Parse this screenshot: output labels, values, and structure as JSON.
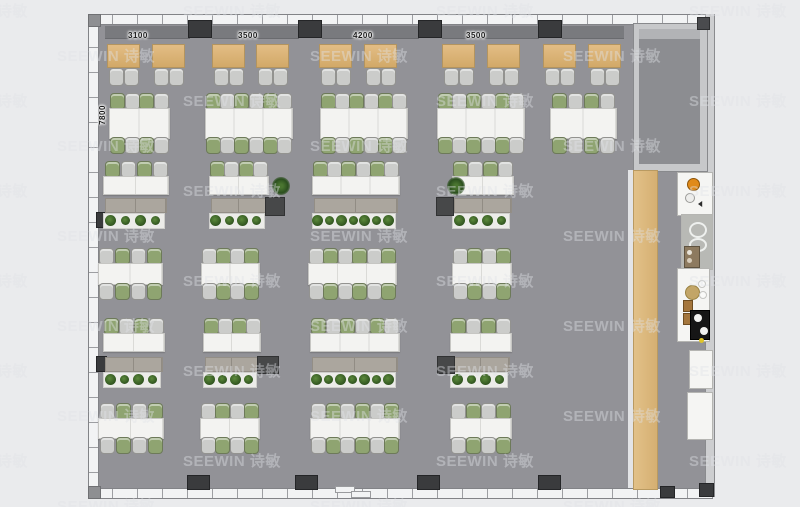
{
  "watermark": {
    "text": "SEEWIN 诗敏"
  },
  "labels": {
    "top_dimensions": [
      {
        "text": "3100",
        "cx": 142,
        "y": 31
      },
      {
        "text": "3500",
        "cx": 252,
        "y": 31
      },
      {
        "text": "4200",
        "cx": 367,
        "y": 31
      },
      {
        "text": "3500",
        "cx": 480,
        "y": 31
      }
    ],
    "left_dimension": {
      "text": "7800",
      "x": 90,
      "y": 103
    }
  },
  "colors": {
    "floor": "#929297",
    "outer_background": "#eaebed",
    "wall_window": "#f2f3f4",
    "column": "#3a3b3d",
    "booth_table_wood": "#d8b073",
    "bench_band": "#797a7e",
    "chair_green": "#8fa471",
    "chair_gray": "#cbccca",
    "desk_white": "#f3f3f1",
    "soft_bench": "#aba69e",
    "planter_box": "#ecece9",
    "plant_green": "#3f6b2f",
    "wood_strip": "#d9b67c",
    "accent_orange": "#e08a1a",
    "appliance_black": "#161616"
  },
  "plan": {
    "building": {
      "x": 88,
      "y": 14,
      "w": 625,
      "h": 483
    },
    "room": {
      "x": 633,
      "y": 23,
      "w": 73,
      "h": 147
    },
    "columns_top": [
      188,
      298,
      418,
      538
    ],
    "columns_bottom": [
      187,
      295,
      417,
      538
    ],
    "wall_blocks": [
      {
        "x": 96,
        "y": 212
      },
      {
        "x": 96,
        "y": 356
      }
    ],
    "bench_band_segments": [
      [
        105,
        85
      ],
      [
        212,
        87
      ],
      [
        322,
        97
      ],
      [
        442,
        97
      ],
      [
        562,
        62
      ]
    ],
    "booth_tables": [
      107,
      152,
      212,
      256,
      319,
      364,
      442,
      487,
      543,
      588
    ],
    "booth_table_y": 44,
    "booth_chair_y": 68,
    "workstation_rows": [
      {
        "y": 108,
        "h": 29,
        "first": "green",
        "clusters": [
          {
            "x": 109,
            "w": 59,
            "seats": 4
          },
          {
            "x": 205,
            "w": 86,
            "seats": 6
          },
          {
            "x": 320,
            "w": 86,
            "seats": 6
          },
          {
            "x": 437,
            "w": 86,
            "seats": 6
          },
          {
            "x": 550,
            "w": 65,
            "seats": 4
          }
        ]
      },
      {
        "y": 263,
        "h": 20,
        "first": "gray",
        "clusters": [
          {
            "x": 98,
            "w": 63,
            "seats": 4
          },
          {
            "x": 201,
            "w": 57,
            "seats": 4
          },
          {
            "x": 308,
            "w": 87,
            "seats": 6
          },
          {
            "x": 452,
            "w": 58,
            "seats": 4
          }
        ]
      },
      {
        "y": 418,
        "h": 19,
        "first": "gray",
        "clusters": [
          {
            "x": 98,
            "w": 64,
            "seats": 4
          },
          {
            "x": 200,
            "w": 58,
            "seats": 4
          },
          {
            "x": 310,
            "w": 88,
            "seats": 6
          },
          {
            "x": 450,
            "w": 60,
            "seats": 4
          }
        ]
      }
    ],
    "planter_rows": [
      {
        "desk_y": 176,
        "desk_h": 17,
        "bench_y": 198,
        "planter_y": 213,
        "first": "green",
        "clusters": [
          {
            "x": 103,
            "w": 64,
            "seats": 4,
            "plants": 4
          },
          {
            "x": 209,
            "w": 58,
            "seats": 4,
            "plants": 4
          },
          {
            "x": 312,
            "w": 86,
            "seats": 6,
            "plants": 7
          },
          {
            "x": 452,
            "w": 60,
            "seats": 4,
            "plants": 4
          }
        ],
        "side_boxes": [
          {
            "x": 265,
            "y": 197,
            "w": 18,
            "h": 17
          },
          {
            "x": 436,
            "y": 197,
            "w": 16,
            "h": 17
          }
        ],
        "loose_plants": [
          {
            "x": 272,
            "y": 177
          },
          {
            "x": 447,
            "y": 177
          }
        ]
      },
      {
        "desk_y": 333,
        "desk_h": 17,
        "bench_y": 357,
        "planter_y": 372,
        "first": "green",
        "clusters": [
          {
            "x": 103,
            "w": 60,
            "seats": 4,
            "plants": 4
          },
          {
            "x": 203,
            "w": 56,
            "seats": 4,
            "plants": 4
          },
          {
            "x": 310,
            "w": 88,
            "seats": 6,
            "plants": 7
          },
          {
            "x": 450,
            "w": 60,
            "seats": 4,
            "plants": 4
          }
        ],
        "side_boxes": [
          {
            "x": 257,
            "y": 356,
            "w": 20,
            "h": 16
          },
          {
            "x": 437,
            "y": 356,
            "w": 16,
            "h": 16
          }
        ],
        "loose_plants": []
      }
    ],
    "wood_strip": {
      "x": 633,
      "y": 170,
      "w": 23,
      "h": 318
    },
    "fixtures": [
      {
        "x": 677,
        "y": 172,
        "w": 34,
        "h": 42,
        "kind": "cooktop"
      },
      {
        "x": 681,
        "y": 214,
        "w": 30,
        "h": 54,
        "kind": "sink"
      },
      {
        "x": 677,
        "y": 268,
        "w": 31,
        "h": 72,
        "kind": "pantry"
      },
      {
        "x": 689,
        "y": 350,
        "w": 22,
        "h": 37,
        "kind": "counter"
      },
      {
        "x": 687,
        "y": 392,
        "w": 24,
        "h": 46,
        "kind": "counter"
      }
    ],
    "door": {
      "x": 335,
      "y": 486
    },
    "corner_blocks": [
      {
        "x": 660,
        "y": 486,
        "w": 13,
        "h": 10
      },
      {
        "x": 699,
        "y": 483,
        "w": 13,
        "h": 12
      }
    ]
  }
}
